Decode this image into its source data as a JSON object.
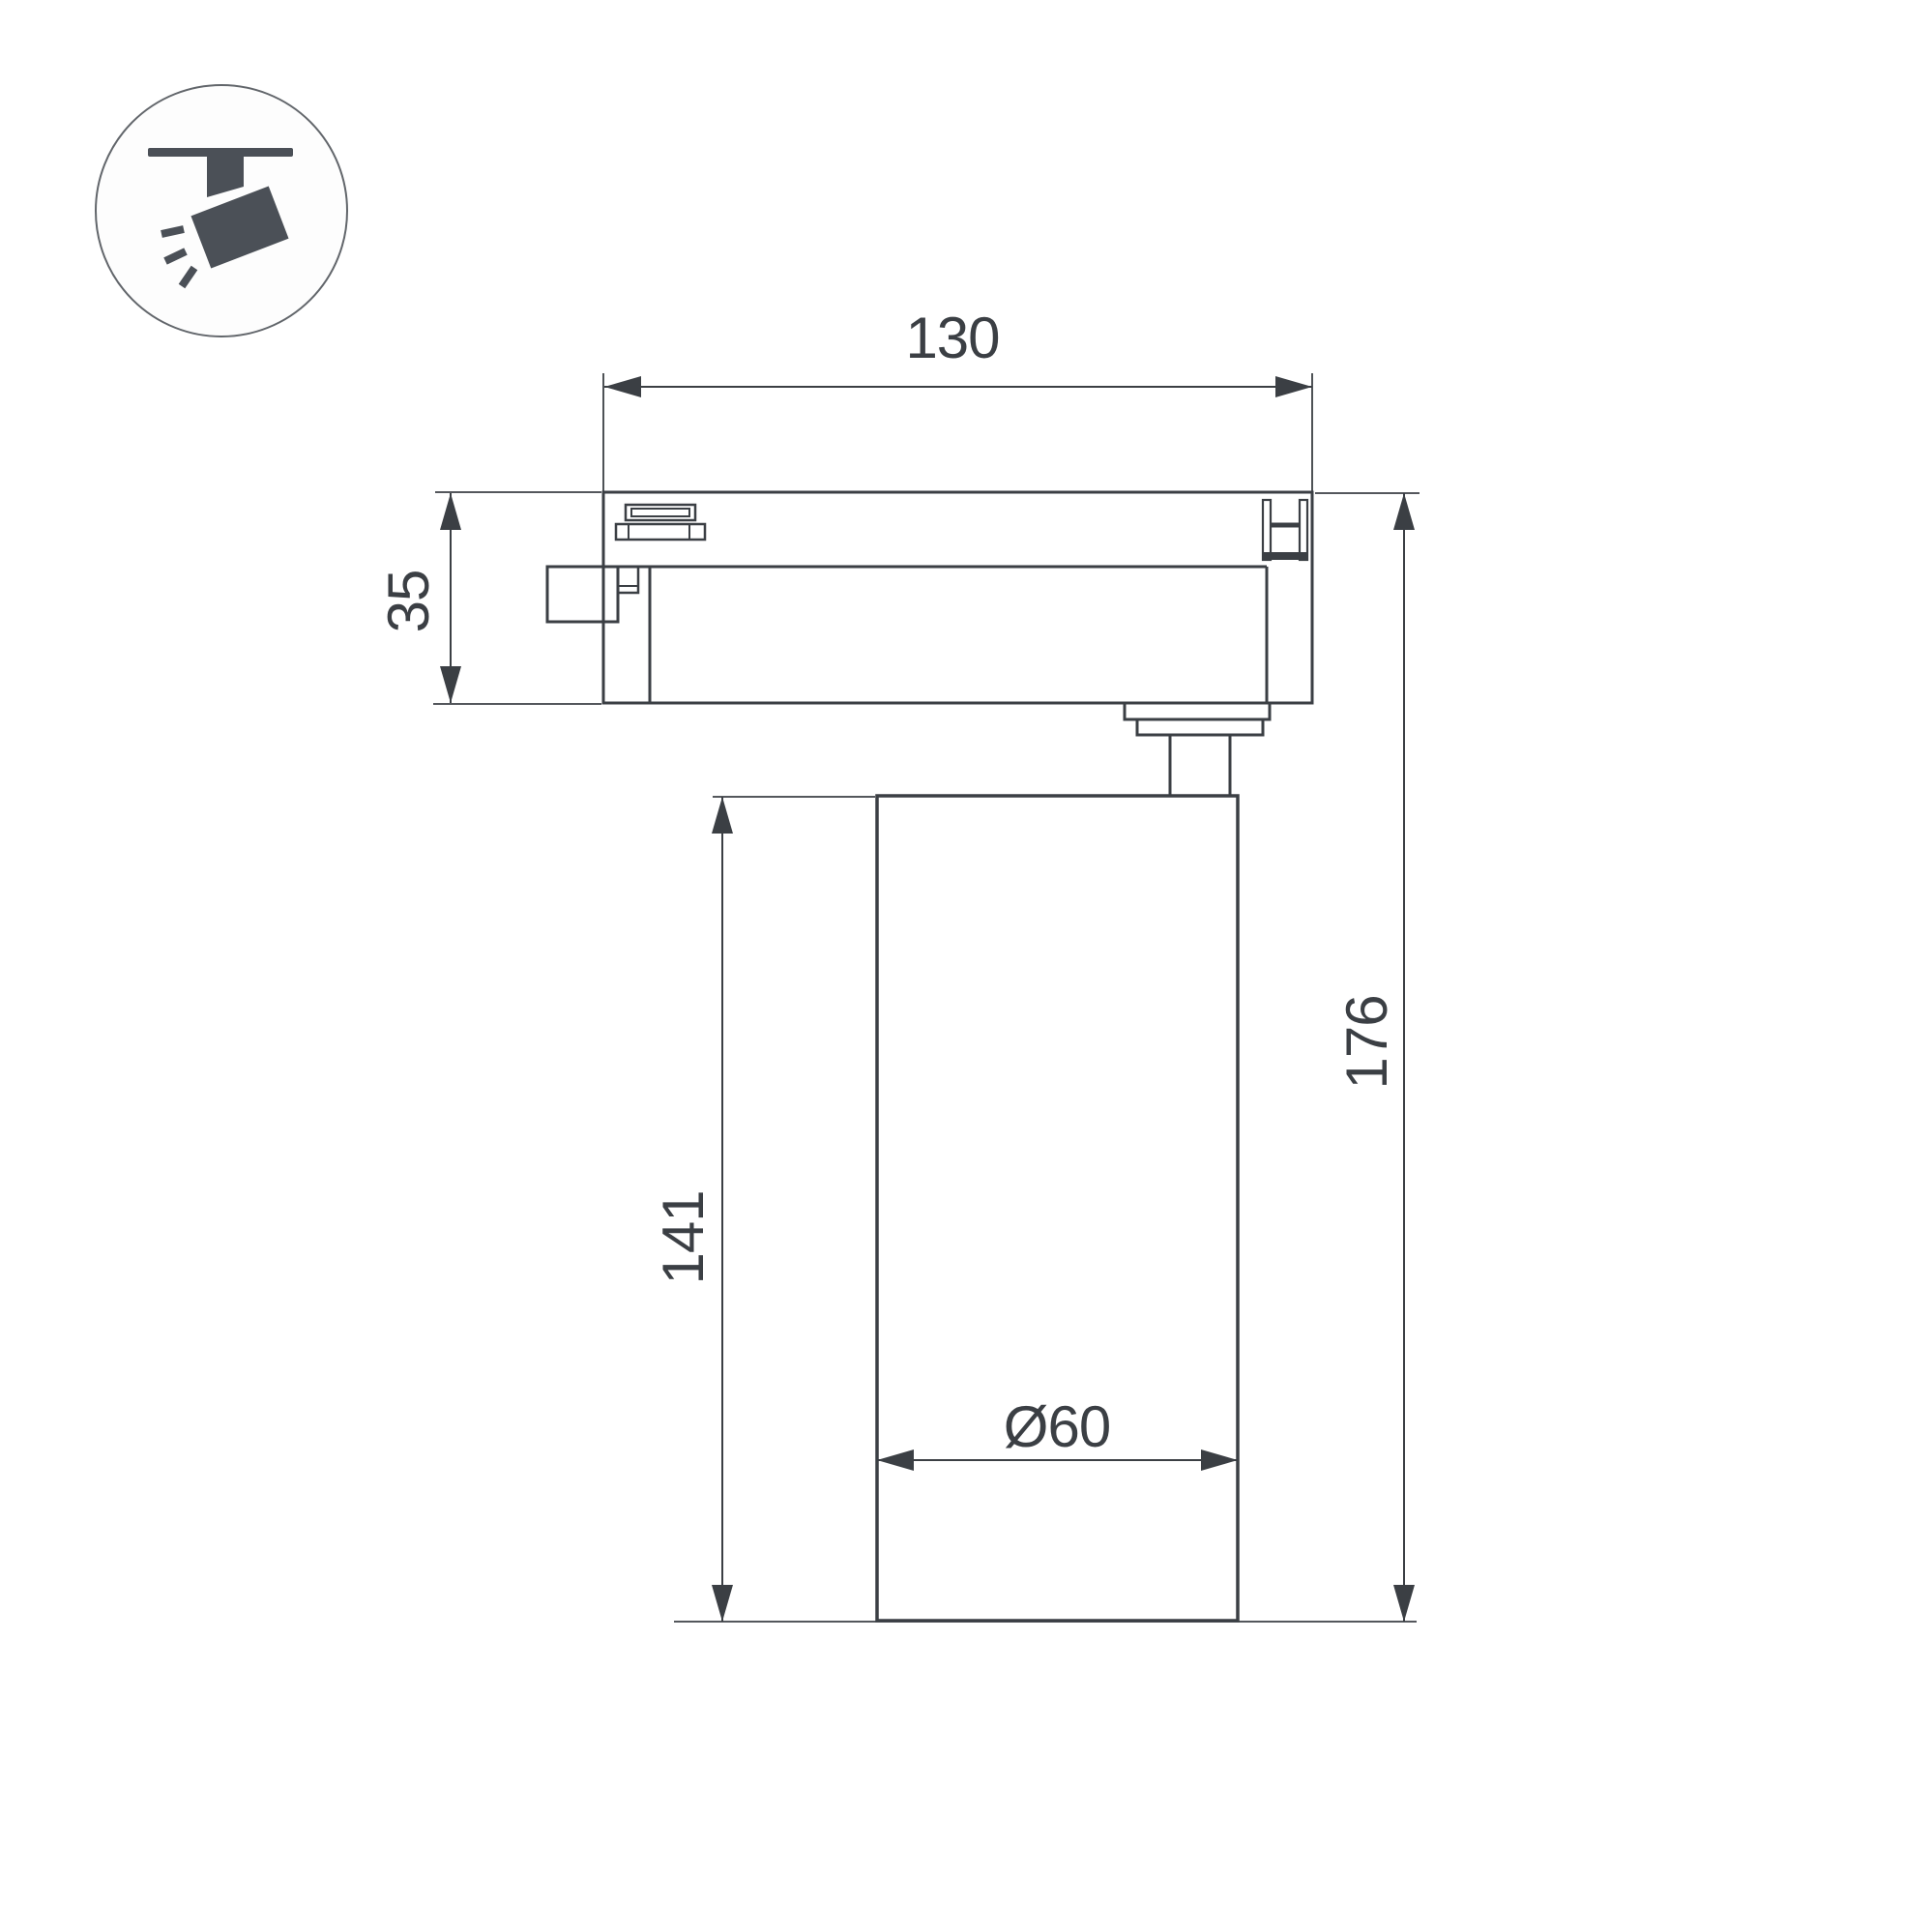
{
  "colors": {
    "background": "#ffffff",
    "line": "#3b3f44",
    "icon_fill": "#4b5057",
    "circle_stroke": "#62666b"
  },
  "icon": {
    "name": "track-spotlight-pictogram"
  },
  "dimension_labels": {
    "track_adapter_width": "130",
    "track_adapter_height": "35",
    "lamp_body_height": "141",
    "total_height": "176",
    "lamp_body_diameter": "Ø60"
  }
}
